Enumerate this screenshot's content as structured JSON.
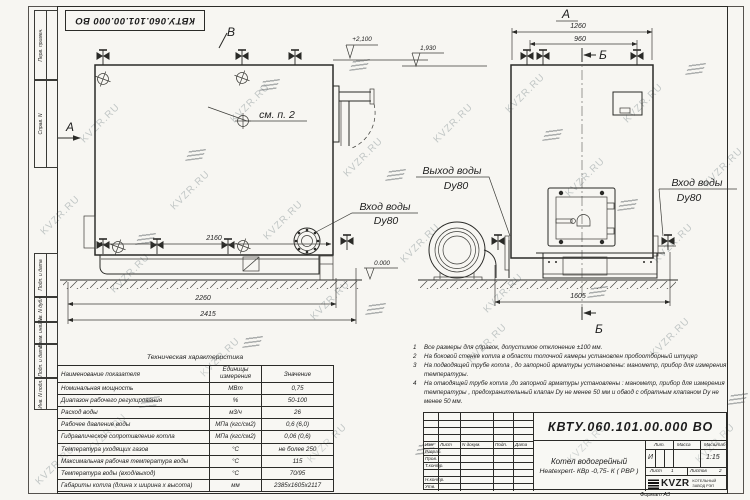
{
  "watermark": {
    "text": "KVZR.RU"
  },
  "frame": {
    "top_stamp": "КВТУ.060.101.00.000  ВО",
    "margin_labels": [
      "Перв. примен.",
      "Справ. N",
      "Подп. и дата",
      "Инв. N дубл.",
      "Взам. инв. N",
      "Подп. и дата",
      "Инв. N подл."
    ],
    "format_note": "Формат  А3"
  },
  "views": {
    "front": {
      "section_a": "А",
      "section_b": "В",
      "callout": "см. п. 2",
      "dims": {
        "width_top": "2160",
        "width_mid": "2260",
        "width_full": "2415"
      },
      "elevations": {
        "top": "+2,100",
        "flue": "1,930",
        "ground": "0.000"
      },
      "inlet_label": {
        "line1": "Вход воды",
        "line2": "Dy80"
      }
    },
    "side": {
      "section_a": "А",
      "section_b_top": "Б",
      "section_b_bottom": "Б",
      "dims": {
        "width_top": "1260",
        "width_inner": "960",
        "width_base": "1605"
      },
      "outlet_label": {
        "line1": "Выход воды",
        "line2": "Dy80"
      },
      "inlet_label": {
        "line1": "Вход воды",
        "line2": "Dy80"
      }
    }
  },
  "notes": {
    "items": [
      {
        "num": "1",
        "text": "Все размеры для справок, допустимое отклонение ±100 мм."
      },
      {
        "num": "2",
        "text": "На боковой стенке котла в области топочной камеры установлен пробоотборный штуцер"
      },
      {
        "num": "3",
        "text": "На  подводящей трубе котла , до запорной арматуры установлены: манометр, прибор для измерения температуры."
      },
      {
        "num": "4",
        "text": "На отводящей трубе котла ,до запорной арматуры установлены : манометр, прибор для измерения температуры , предохранительный клапан Dy не менее 50 мм и обвод с обратным клапаном Dy не менее 50 мм."
      }
    ]
  },
  "tech_table": {
    "title": "Техническая характеристика",
    "headers": {
      "name": "Наименование показателя",
      "units_line1": "Единицы",
      "units_line2": "измерения",
      "value": "Значение"
    },
    "rows": [
      {
        "name": "Номинальная мощность",
        "units": "МВт",
        "value": "0,75"
      },
      {
        "name": "Диапазон рабочего регулирования",
        "units": "%",
        "value": "50-100"
      },
      {
        "name": "Расход воды",
        "units": "м3/ч",
        "value": "26"
      },
      {
        "name": "Рабочее давление воды",
        "units": "МПа (кгс/см2)",
        "value": "0,6 (6,0)"
      },
      {
        "name": "Гидравлическое сопротивление котла",
        "units": "МПа (кгс/см2)",
        "value": "0,06 (0,6)"
      },
      {
        "name": "Температура уходящих газов",
        "units": "°С",
        "value": "не более 250"
      },
      {
        "name": "Максимальная рабочая температура воды",
        "units": "°С",
        "value": "115"
      },
      {
        "name": "Температура воды (вход/выход)",
        "units": "°С",
        "value": "70/95"
      },
      {
        "name": "Габариты котла (длина х ширина х высота)",
        "units": "мм",
        "value": "2385х1605х2117"
      }
    ]
  },
  "title_block": {
    "code": "КВТУ.060.101.00.000  ВО",
    "header_cells": [
      "Изм",
      "Лист",
      "N докум.",
      "Подп.",
      "Дата"
    ],
    "sign_rows": [
      "Разраб.",
      "Пров.",
      "Т.контр.",
      "Н.контр.",
      "Утв."
    ],
    "product_name_line1": "Котел водогрейный",
    "product_name_line2": "Heatexpert- КВр -0,75- К ( РВР )",
    "lit_label": "Лит.",
    "lit_value": "И",
    "mass_label": "Масса",
    "scale_label": "Масштаб",
    "scale_value": "1:15",
    "sheet_label": "Лист",
    "sheet_value": "1",
    "sheets_label": "Листов",
    "sheets_value": "2",
    "company": {
      "logo": "KVZR",
      "name_line1": "КОТЕЛЬНЫЙ",
      "name_line2": "ЗАВОД РЭП"
    }
  }
}
